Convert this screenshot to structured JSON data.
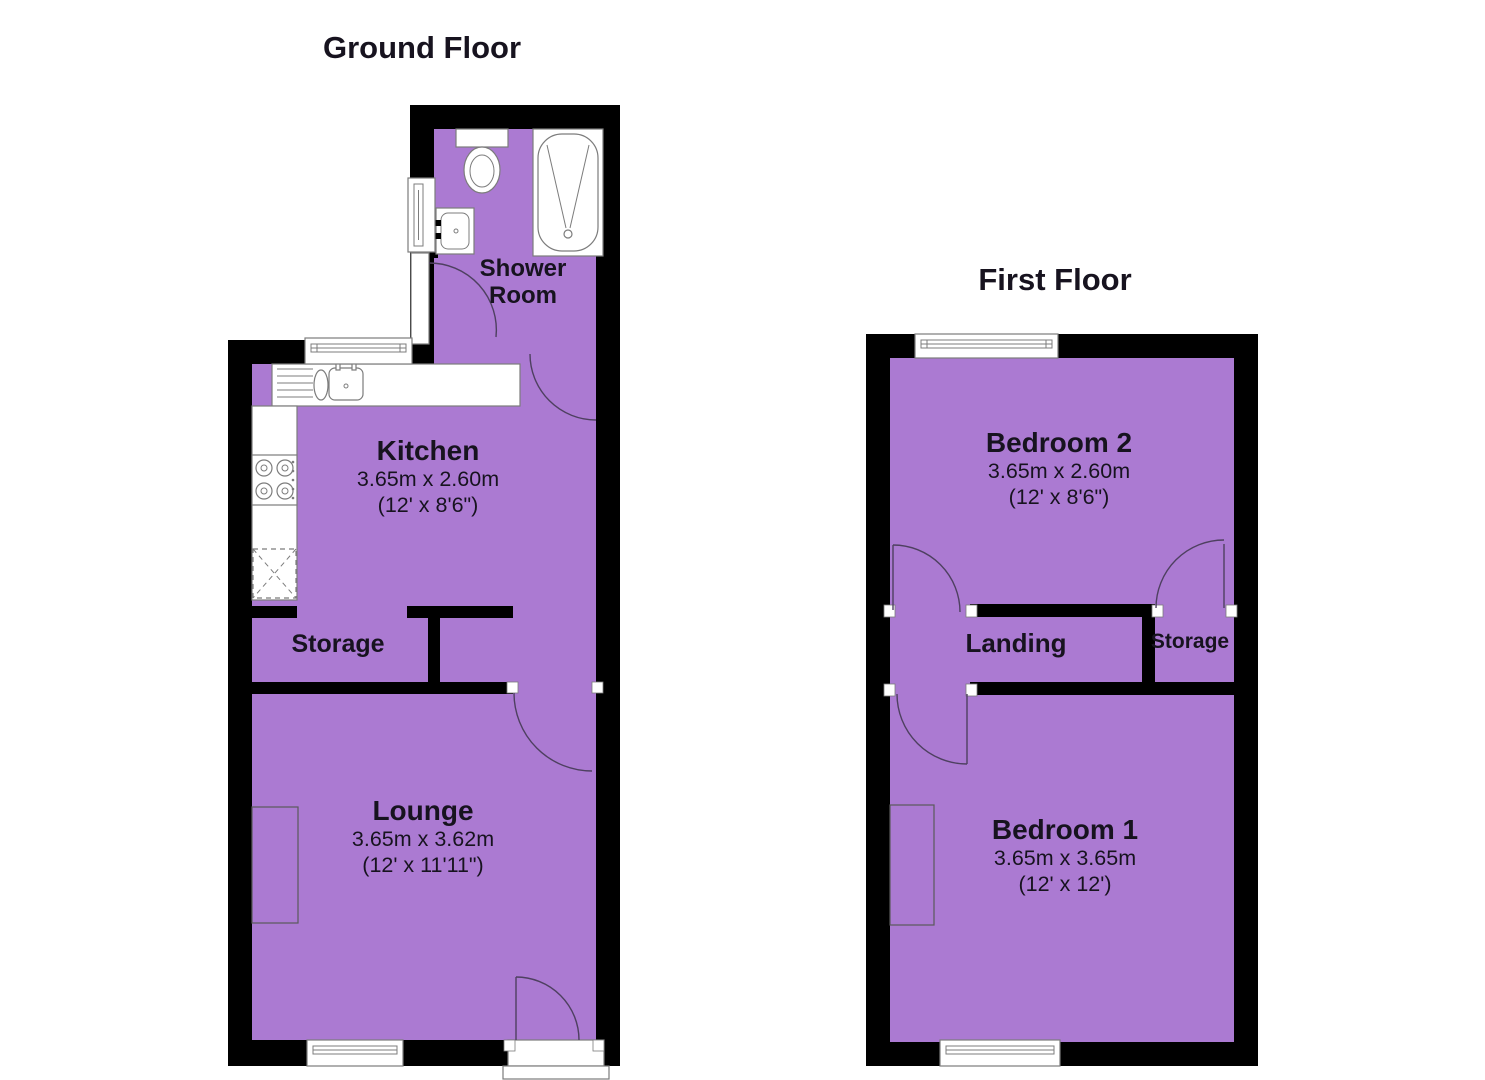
{
  "colors": {
    "room_fill": "#AB7AD2",
    "wall": "#000000",
    "label_text": "#17131F",
    "fixture_stroke": "#7C7C7C",
    "door_arc": "#4E4060"
  },
  "floors": [
    {
      "title": "Ground Floor",
      "rooms": [
        {
          "name": "Shower Room"
        },
        {
          "name": "Kitchen",
          "size_metric": "3.65m x 2.60m",
          "size_imperial": "(12' x 8'6\")"
        },
        {
          "name": "Storage"
        },
        {
          "name": "Lounge",
          "size_metric": "3.65m x 3.62m",
          "size_imperial": "(12' x 11'11\")"
        }
      ]
    },
    {
      "title": "First Floor",
      "rooms": [
        {
          "name": "Bedroom 2",
          "size_metric": "3.65m x 2.60m",
          "size_imperial": "(12' x 8'6\")"
        },
        {
          "name": "Landing"
        },
        {
          "name": "Storage"
        },
        {
          "name": "Bedroom 1",
          "size_metric": "3.65m x 3.65m",
          "size_imperial": "(12' x 12')"
        }
      ]
    }
  ]
}
